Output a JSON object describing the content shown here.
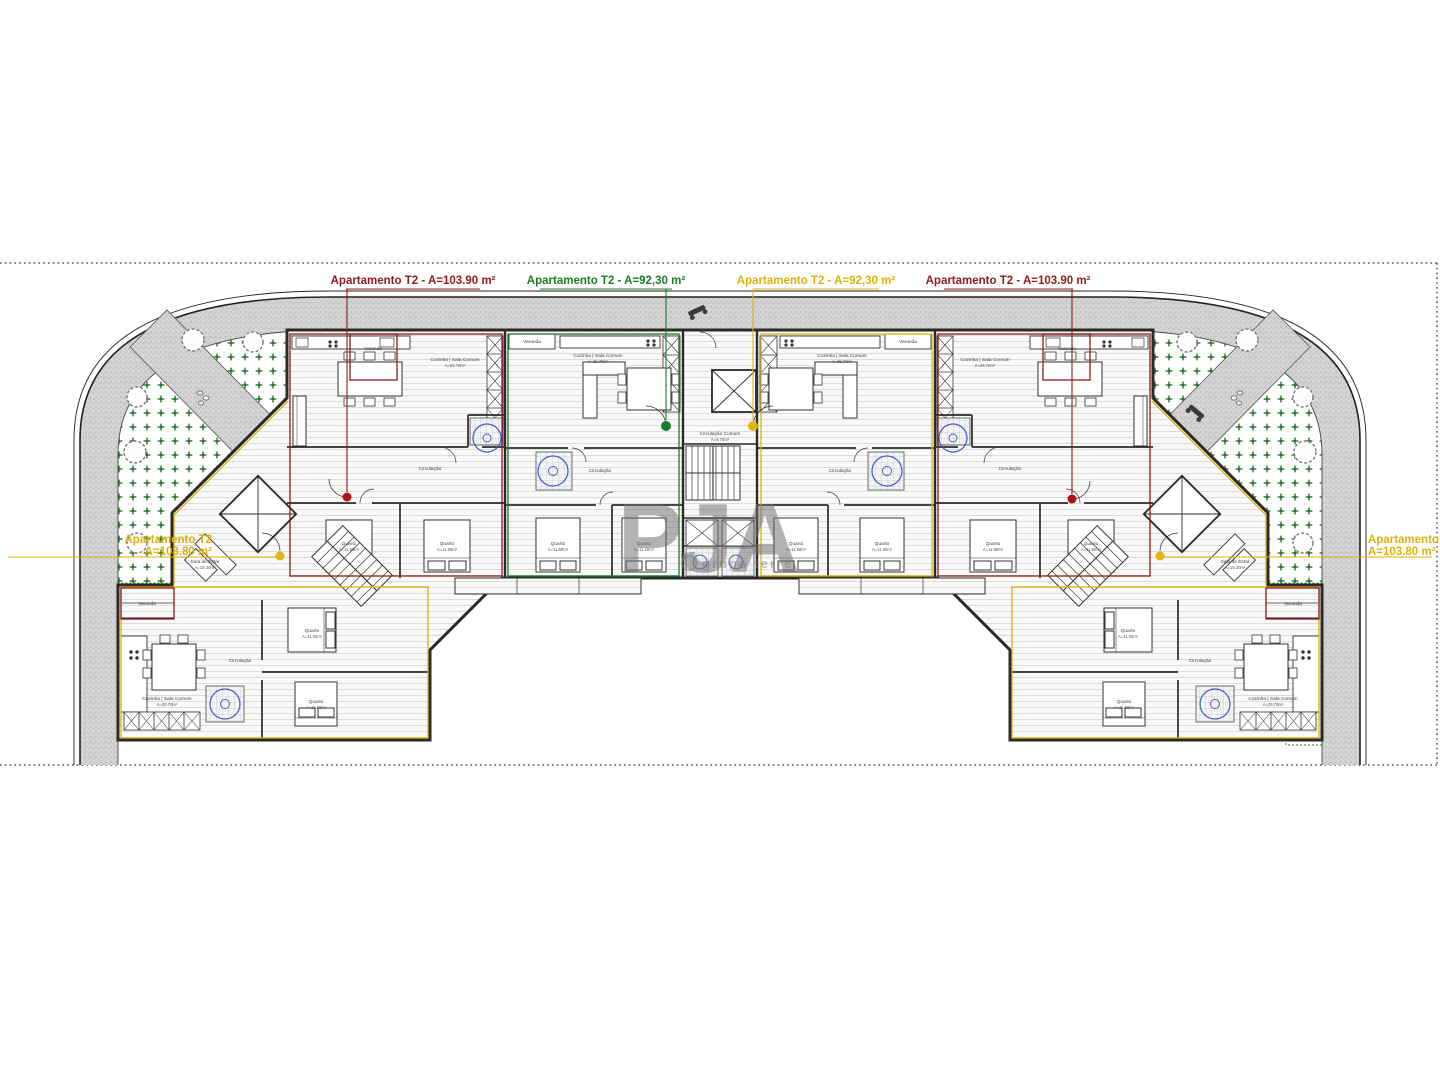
{
  "drawing": {
    "type": "architectural floor plan - apartment block, ground floor",
    "top_labels": [
      {
        "text": "Apartamento T2 - A=103.90 m²",
        "color": "#8e1b1b"
      },
      {
        "text": "Apartamento T2 - A=92,30 m²",
        "color": "#1d7a2b"
      },
      {
        "text": "Apartamento T2 - A=92,30 m²",
        "color": "#dcb20c"
      },
      {
        "text": "Apartamento T2 - A=103.90 m²",
        "color": "#8e1b1b"
      }
    ],
    "side_labels": {
      "left": {
        "line1": "Apartamento T2",
        "line2": "A=103.80 m²",
        "color": "#dcb20c"
      },
      "right": {
        "line1": "Apartamento T2",
        "line2": "A=103.80 m²",
        "color": "#dcb20c"
      }
    },
    "watermark": {
      "title": "PJA",
      "subtitle": "grupo terre"
    },
    "room_labels": {
      "cozinha": "Cozinha | Sala Comum",
      "quarto": "Quarto",
      "circulacao": "Circulação",
      "circulacao_comum": "Circulação Comum",
      "varanda": "Varanda",
      "sala_estar": "Sala de Estar",
      "area_cozinha": "A=25.70m²",
      "area_quarto": "A=11.50m²",
      "area_varanda": "A=4.30m²",
      "area_circ": "A=8.70m²",
      "area_sala": "A=15.30m²"
    },
    "colors": {
      "apartment_red": "#8e1b1b",
      "apartment_green": "#1d7a2b",
      "apartment_yellow": "#dcb20c",
      "sanitary_blue": "#3c5bc7",
      "garden_green": "#2e7d32",
      "pavement_grey": "#d2d2d2"
    }
  }
}
